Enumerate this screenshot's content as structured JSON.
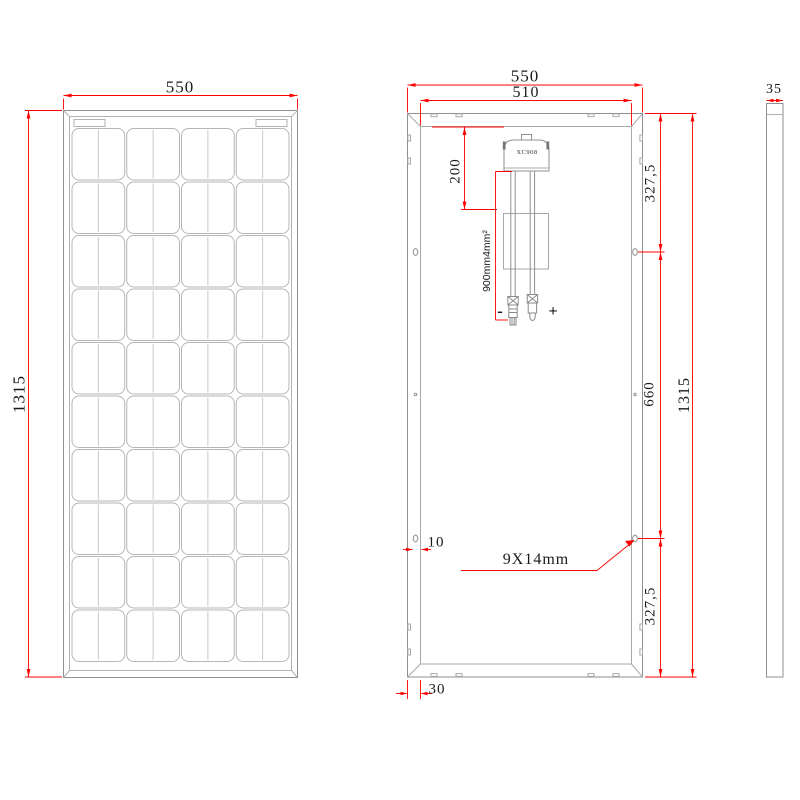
{
  "title": "Solar panel dimensional drawing",
  "colors": {
    "dimension": "#ff0000",
    "line": "#8f8f8f",
    "text": "#1a1a1a"
  },
  "front_view": {
    "width": "550",
    "height": "1315",
    "cells": {
      "rows": 10,
      "cols": 4
    }
  },
  "back_view": {
    "outer_width": "550",
    "inner_width": "510",
    "height": "1315",
    "top_hole_offset": "327,5",
    "hole_spacing": "660",
    "bottom_hole_offset": "327,5",
    "junction_box_model": "XC908",
    "junction_box_offset": "200",
    "cable_spec": "900mm4mm²",
    "negative": "-",
    "positive": "+",
    "mounting_hole_size": "9X14mm",
    "hole_edge_offset": "10",
    "drain_edge_offset": "30"
  },
  "side_view": {
    "thickness": "35"
  }
}
